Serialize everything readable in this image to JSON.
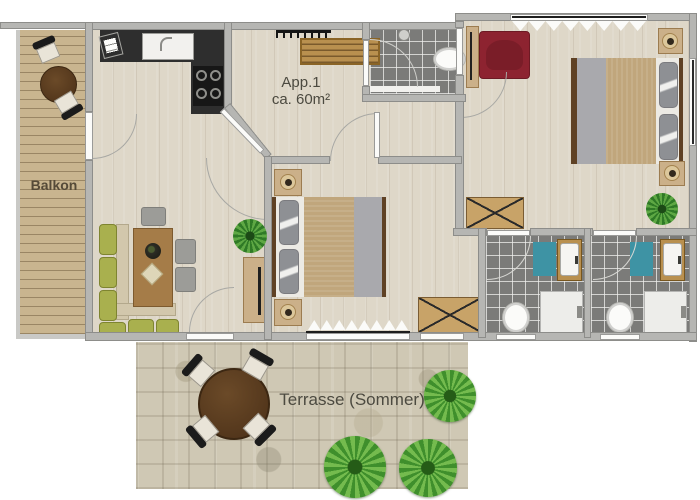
{
  "floorplan": {
    "apartment_label": "App.1",
    "apartment_area": "ca. 60m²",
    "balcony_label": "Balkon",
    "terrace_label": "Terrasse (Sommer)"
  },
  "colors": {
    "wall": "#b6b6b3",
    "wallEdge": "#8d8d8a",
    "floor": "#ded7c8",
    "balconyWood": "#c9b58f",
    "counter": "#2e2e2e",
    "tile": "#7b7b79",
    "matTeal": "#3e93a4",
    "armchairRed": "#8d2330",
    "bedTan": "#c0a67c",
    "bedGray": "#a9a9ad",
    "pillowGray": "#8e9094",
    "sofaOlive": "#a9b04e",
    "sofaSeat": "#d2c7ac",
    "tableWood": "#a57c48",
    "darkWood": "#5f4124",
    "nightstandWood": "#cbb089",
    "wardrobeWood": "#c8a368",
    "sideboardWood": "#b9904f",
    "stone": "#cfc8b4",
    "plantGreen": "#4e9335",
    "labelText": "#4c4a40",
    "doorWhite": "#fbfbf9"
  }
}
